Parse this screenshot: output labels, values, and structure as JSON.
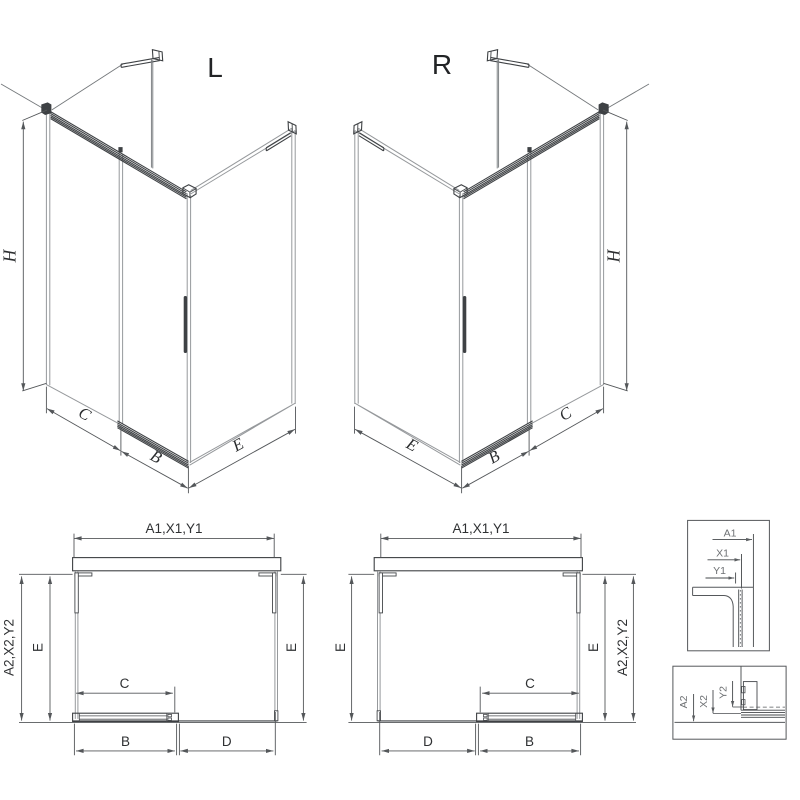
{
  "drawing": {
    "iso_left": {
      "variant_label": "L",
      "dims": {
        "height": "H",
        "front_fixed": "C",
        "door": "B",
        "side": "E"
      }
    },
    "iso_right": {
      "variant_label": "R",
      "dims": {
        "height": "H",
        "front_fixed": "C",
        "door": "B",
        "side": "E"
      }
    },
    "plan_left": {
      "dims": {
        "top": "A1,X1,Y1",
        "left_outer": "A2,X2,Y2",
        "side_left": "E",
        "side_right": "E",
        "opening": "C",
        "door": "B",
        "fixed": "D"
      }
    },
    "plan_right": {
      "dims": {
        "top": "A1,X1,Y1",
        "right_outer": "A2,X2,Y2",
        "side_left": "E",
        "side_right": "E",
        "opening": "C",
        "door": "B",
        "fixed": "D"
      }
    },
    "detail_wall_profile": {
      "dims": {
        "a": "A1",
        "x": "X1",
        "y": "Y1"
      }
    },
    "detail_floor_profile": {
      "dims": {
        "a": "A2",
        "x": "X2",
        "y": "Y2"
      }
    },
    "colors": {
      "line_dark": "#3e4144",
      "line_glass": "#96999c",
      "line_dim": "#54575a",
      "text": "#2f3133",
      "text_detail": "#6e7174",
      "background": "#ffffff"
    }
  }
}
